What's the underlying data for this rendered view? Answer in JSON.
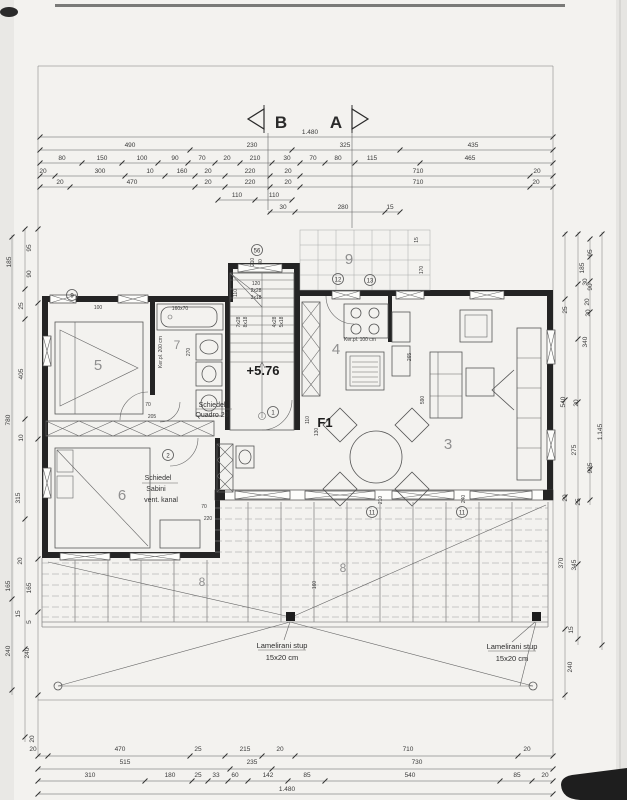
{
  "section_markers": {
    "b": "B",
    "a": "A"
  },
  "levels": {
    "height": "+5.76",
    "zone": "F1"
  },
  "overall": {
    "top": "1.480",
    "bottom": "1.480"
  },
  "rooms": [
    "5",
    "7",
    "6",
    "4",
    "3",
    "9",
    "8",
    "8"
  ],
  "markers": [
    "9",
    "56",
    "12",
    "13",
    "2",
    "1",
    "11",
    "11"
  ],
  "stairs": [
    "120",
    "2x28",
    "3x18",
    "7x28",
    "8x18",
    "4x28",
    "5x18",
    "110",
    "210",
    "80"
  ],
  "notes": {
    "schiedel1": "Schiedel",
    "schiedel2": "Quadro 20",
    "sabini1": "Schiedel",
    "sabini2": "Sabini",
    "sabini3": "vent. kanal",
    "ker_kitchen": "Ker.pl. 100 cm",
    "ker_bath": "Ker.pl. 200 cm",
    "tub": "160x70",
    "stup_l1": "Lamelirani stup",
    "stup_l2": "15x20 cm",
    "stup_r1": "Lamelirani stup",
    "stup_r2": "15x20 cm"
  },
  "dims": {
    "t1": [
      "490",
      "230",
      "325",
      "435"
    ],
    "t2": [
      "80",
      "150",
      "100",
      "90",
      "70",
      "20",
      "210",
      "30",
      "70",
      "80",
      "115",
      "465"
    ],
    "t3": [
      "20",
      "300",
      "10",
      "160",
      "20",
      "220",
      "20",
      "710",
      "20"
    ],
    "t4": [
      "20",
      "470",
      "20",
      "220",
      "20",
      "710",
      "20"
    ],
    "t5": [
      "110",
      "110"
    ],
    "t6": [
      "30",
      "280",
      "15"
    ],
    "b1": [
      "20",
      "470",
      "25",
      "215",
      "20",
      "710",
      "20"
    ],
    "b2": [
      "515",
      "235",
      "730"
    ],
    "b3": [
      "310",
      "180",
      "25",
      "33",
      "60",
      "142",
      "85",
      "540",
      "85",
      "20"
    ],
    "l": [
      "185",
      "95",
      "90",
      "25",
      "405",
      "10",
      "780",
      "315",
      "20",
      "165",
      "165",
      "15",
      "5",
      "240",
      "240",
      "20"
    ],
    "r": [
      "185",
      "95",
      "30",
      "90",
      "25",
      "20",
      "20",
      "340",
      "540",
      "20",
      "1.145",
      "275",
      "935",
      "20",
      "25",
      "370",
      "345",
      "15",
      "240"
    ],
    "i": [
      "100",
      "70",
      "205",
      "70",
      "220",
      "590",
      "265",
      "270",
      "170",
      "15",
      "160",
      "110",
      "130",
      "210",
      "240"
    ]
  }
}
